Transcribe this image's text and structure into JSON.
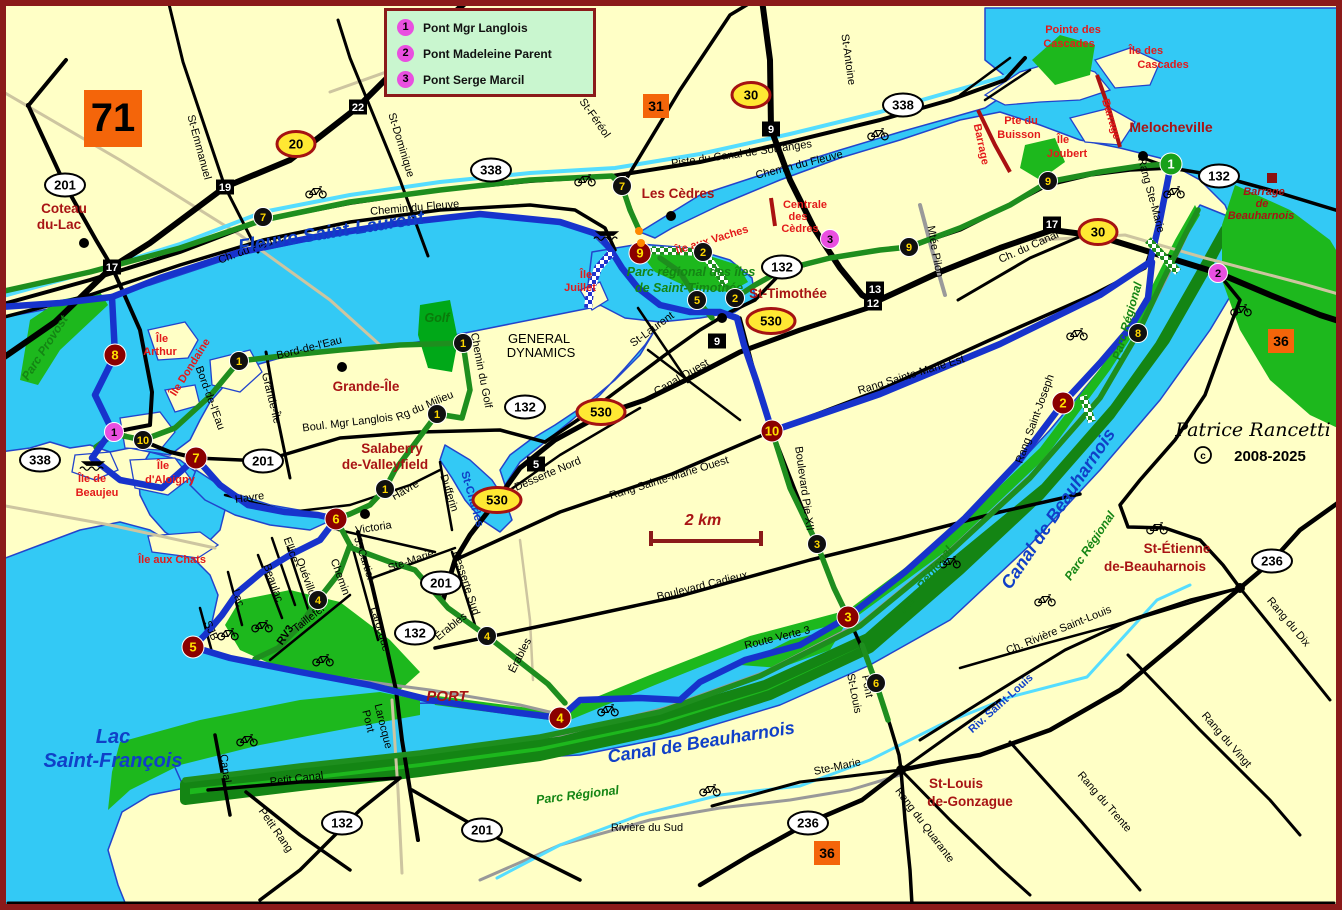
{
  "map_number": "71",
  "legend": {
    "items": [
      {
        "num": "1",
        "label": "Pont Mgr Langlois"
      },
      {
        "num": "2",
        "label": "Pont Madeleine Parent"
      },
      {
        "num": "3",
        "label": "Pont Serge Marcil"
      }
    ]
  },
  "copyright": {
    "signature": "Patrice Rancetti",
    "years": "2008-2025"
  },
  "scale": {
    "label": "2 km"
  },
  "palette": {
    "road": "#000000",
    "town": "#A81414",
    "island": "#E31A1A",
    "water": "#1040C8",
    "park": "#148514",
    "golf": "#0A7A0A",
    "sig": "#000000",
    "water_fill": "#33C9F5",
    "land": "#FFFFC6",
    "green_fill": "#1DB81D",
    "blue_route": "#1733CC",
    "green_route": "#1E8E1E",
    "maroon": "#8B0000",
    "magenta": "#E94FE0",
    "orange_ref": "#F4650A",
    "shield_yellow": "#FFE833"
  },
  "labels": [
    {
      "t": "St-Emmanuel",
      "x": 196,
      "y": 148,
      "r": 75
    },
    {
      "t": "St-Dominique",
      "x": 398,
      "y": 146,
      "r": 73
    },
    {
      "t": "St-Féréol",
      "x": 592,
      "y": 120,
      "r": 55
    },
    {
      "t": "St-Antoine",
      "x": 845,
      "y": 60,
      "r": 82
    },
    {
      "t": "Piste du Canal de Soulanges",
      "x": 742,
      "y": 157,
      "r": -8
    },
    {
      "t": "Chemin du Fleuve",
      "x": 800,
      "y": 168,
      "r": -14
    },
    {
      "t": "Chemin du Fleuve",
      "x": 415,
      "y": 211,
      "r": -5
    },
    {
      "t": "Ch. du Fleuve",
      "x": 252,
      "y": 252,
      "r": -20
    },
    {
      "t": "Ch. du Canal",
      "x": 1030,
      "y": 250,
      "r": -24
    },
    {
      "t": "Mtée Pilon",
      "x": 932,
      "y": 252,
      "r": 80
    },
    {
      "t": "Rang Ste-Marie",
      "x": 1148,
      "y": 196,
      "r": 75
    },
    {
      "t": "Canal Ouest",
      "x": 683,
      "y": 380,
      "r": -30
    },
    {
      "t": "St-Laurent",
      "x": 654,
      "y": 332,
      "r": -36
    },
    {
      "t": "Rang Sainte-Marie Est",
      "x": 912,
      "y": 378,
      "r": -17
    },
    {
      "t": "Rang Sainte-Marie Ouest",
      "x": 670,
      "y": 481,
      "r": -17
    },
    {
      "t": "Boulevard Pie XII",
      "x": 801,
      "y": 489,
      "r": 82
    },
    {
      "t": "Boulevard Cadieux",
      "x": 703,
      "y": 589,
      "r": -14
    },
    {
      "t": "Route Verte 3",
      "x": 778,
      "y": 641,
      "r": -14
    },
    {
      "t": "Desserte Nord",
      "x": 549,
      "y": 477,
      "r": -23
    },
    {
      "t": "Desserte Sud",
      "x": 463,
      "y": 584,
      "r": 72
    },
    {
      "t": "Rang Saint-Joseph",
      "x": 1038,
      "y": 420,
      "r": -70
    },
    {
      "t": "Rang du Dix",
      "x": 1286,
      "y": 624,
      "r": 50
    },
    {
      "t": "Rang du Vingt",
      "x": 1224,
      "y": 742,
      "r": 49
    },
    {
      "t": "Rang du Trente",
      "x": 1102,
      "y": 804,
      "r": 49
    },
    {
      "t": "Ch. Rivière Saint-Louis",
      "x": 1060,
      "y": 633,
      "r": -22
    },
    {
      "t": "Rang du Quarante",
      "x": 922,
      "y": 827,
      "r": 53
    },
    {
      "t": "Ste-Marie",
      "x": 838,
      "y": 770,
      "r": -12
    },
    {
      "t": "Ste-Marie",
      "x": 412,
      "y": 564,
      "r": -19
    },
    {
      "t": "Victoria",
      "x": 374,
      "y": 531,
      "r": -9
    },
    {
      "t": "J.-Cartier",
      "x": 361,
      "y": 560,
      "r": 72
    },
    {
      "t": "Chemin",
      "x": 337,
      "y": 578,
      "r": 70
    },
    {
      "t": "Larocque",
      "x": 377,
      "y": 630,
      "r": 74
    },
    {
      "t": "Ellice",
      "x": 288,
      "y": 551,
      "r": 70
    },
    {
      "t": "Quévillon",
      "x": 304,
      "y": 581,
      "r": 70
    },
    {
      "t": "Beaulac",
      "x": 270,
      "y": 584,
      "r": 70
    },
    {
      "t": "Lac",
      "x": 235,
      "y": 599,
      "r": 70
    },
    {
      "t": "SJB",
      "x": 208,
      "y": 632,
      "r": 66
    },
    {
      "t": "Taillefer",
      "x": 311,
      "y": 621,
      "r": -38
    },
    {
      "t": "RV3",
      "x": 288,
      "y": 637,
      "r": -56,
      "b": 1
    },
    {
      "t": "Havre",
      "x": 250,
      "y": 501,
      "r": -8
    },
    {
      "t": "Havre",
      "x": 407,
      "y": 493,
      "r": -30
    },
    {
      "t": "Dufferin",
      "x": 446,
      "y": 494,
      "r": 72
    },
    {
      "t": "Grande-Île",
      "x": 268,
      "y": 399,
      "r": 76
    },
    {
      "t": "Bord-de-l'Eau",
      "x": 310,
      "y": 351,
      "r": -14
    },
    {
      "t": "Bord-de-l'Eau",
      "x": 207,
      "y": 399,
      "r": 70
    },
    {
      "t": "Rg du Milieu",
      "x": 426,
      "y": 409,
      "r": -23
    },
    {
      "t": "Boul. Mgr Langlois",
      "x": 348,
      "y": 426,
      "r": -7
    },
    {
      "t": "Chemin du Golf",
      "x": 478,
      "y": 371,
      "r": 79
    },
    {
      "t": "Petit Canal",
      "x": 297,
      "y": 782,
      "r": -7
    },
    {
      "t": "Petit Rang",
      "x": 273,
      "y": 832,
      "r": 55
    },
    {
      "t": "Canal",
      "x": 222,
      "y": 769,
      "r": 82
    },
    {
      "t": "Pont",
      "x": 365,
      "y": 722,
      "r": 76
    },
    {
      "t": "Larocque",
      "x": 380,
      "y": 727,
      "r": 76
    },
    {
      "t": "Pont",
      "x": 864,
      "y": 687,
      "r": 79
    },
    {
      "t": "St-Louis",
      "x": 851,
      "y": 694,
      "r": 79
    },
    {
      "t": "Érables",
      "x": 453,
      "y": 629,
      "r": -39
    },
    {
      "t": "Érables",
      "x": 523,
      "y": 657,
      "r": -63
    },
    {
      "t": "Rivière du Sud",
      "x": 647,
      "y": 831
    },
    {
      "t": "GENERAL",
      "x": 539,
      "y": 343,
      "s": 13
    },
    {
      "t": "DYNAMICS",
      "x": 541,
      "y": 357,
      "s": 13
    },
    {
      "t": "Coteau",
      "x": 64,
      "y": 213,
      "c": "town",
      "b": 1,
      "s": 13.5
    },
    {
      "t": "du-Lac",
      "x": 59,
      "y": 229,
      "c": "town",
      "b": 1,
      "s": 13.5
    },
    {
      "t": "Les Cèdres",
      "x": 678,
      "y": 198,
      "c": "town",
      "b": 1,
      "s": 13.5
    },
    {
      "t": "Melocheville",
      "x": 1171,
      "y": 132,
      "c": "town",
      "b": 1,
      "s": 14
    },
    {
      "t": "St-Timothée",
      "x": 788,
      "y": 298,
      "c": "town",
      "b": 1,
      "s": 13.5
    },
    {
      "t": "Grande-Île",
      "x": 366,
      "y": 391,
      "c": "town",
      "b": 1,
      "s": 13.5
    },
    {
      "t": "Salaberry",
      "x": 392,
      "y": 453,
      "c": "town",
      "b": 1,
      "s": 13.5
    },
    {
      "t": "de-Valleyfield",
      "x": 385,
      "y": 469,
      "c": "town",
      "b": 1,
      "s": 13.5
    },
    {
      "t": "St-Louis",
      "x": 956,
      "y": 788,
      "c": "town",
      "b": 1,
      "s": 13.5
    },
    {
      "t": "de-Gonzague",
      "x": 970,
      "y": 806,
      "c": "town",
      "b": 1,
      "s": 13.5
    },
    {
      "t": "St-Étienne",
      "x": 1177,
      "y": 553,
      "c": "town",
      "b": 1,
      "s": 13.5
    },
    {
      "t": "de-Beauharnois",
      "x": 1155,
      "y": 571,
      "c": "town",
      "b": 1,
      "s": 13.5
    },
    {
      "t": "PORT",
      "x": 447,
      "y": 701,
      "c": "town",
      "b": 1,
      "i": 1,
      "s": 15
    },
    {
      "t": "2 km",
      "x": 703,
      "y": 525,
      "c": "town",
      "b": 1,
      "i": 1,
      "s": 16
    },
    {
      "t": "Île",
      "x": 162,
      "y": 342,
      "c": "island",
      "b": 1
    },
    {
      "t": "Arthur",
      "x": 160,
      "y": 355,
      "c": "island",
      "b": 1
    },
    {
      "t": "Île Dondaine",
      "x": 193,
      "y": 369,
      "r": -58,
      "c": "island",
      "b": 1
    },
    {
      "t": "Île de",
      "x": 92,
      "y": 482,
      "c": "island",
      "b": 1
    },
    {
      "t": "Beaujeu",
      "x": 97,
      "y": 496,
      "c": "island",
      "b": 1
    },
    {
      "t": "Île",
      "x": 163,
      "y": 469,
      "c": "island",
      "b": 1
    },
    {
      "t": "d'Aloigny",
      "x": 170,
      "y": 483,
      "c": "island",
      "b": 1
    },
    {
      "t": "Île aux Chats",
      "x": 172,
      "y": 563,
      "c": "island",
      "b": 1
    },
    {
      "t": "Île",
      "x": 586,
      "y": 278,
      "c": "island",
      "b": 1
    },
    {
      "t": "Juillet",
      "x": 580,
      "y": 291,
      "c": "island",
      "b": 1
    },
    {
      "t": "Île aux Vaches",
      "x": 713,
      "y": 243,
      "r": -17,
      "c": "island",
      "b": 1
    },
    {
      "t": "Pointe des",
      "x": 1073,
      "y": 33,
      "c": "island",
      "b": 1
    },
    {
      "t": "Cascades",
      "x": 1069,
      "y": 47,
      "c": "island",
      "b": 1
    },
    {
      "t": "Île des",
      "x": 1146,
      "y": 54,
      "c": "island",
      "b": 1
    },
    {
      "t": "Cascades",
      "x": 1163,
      "y": 68,
      "c": "island",
      "b": 1
    },
    {
      "t": "Pte du",
      "x": 1021,
      "y": 124,
      "c": "island",
      "b": 1
    },
    {
      "t": "Buisson",
      "x": 1019,
      "y": 138,
      "c": "island",
      "b": 1
    },
    {
      "t": "Île",
      "x": 1063,
      "y": 143,
      "c": "island",
      "b": 1
    },
    {
      "t": "Joubert",
      "x": 1067,
      "y": 157,
      "c": "island",
      "b": 1
    },
    {
      "t": "Barrage",
      "x": 978,
      "y": 145,
      "r": 78,
      "c": "island",
      "b": 1
    },
    {
      "t": "Barrage",
      "x": 1108,
      "y": 120,
      "r": 73,
      "c": "island",
      "b": 1
    },
    {
      "t": "Centrale",
      "x": 805,
      "y": 208,
      "c": "island",
      "b": 1
    },
    {
      "t": "des",
      "x": 798,
      "y": 220,
      "c": "island",
      "b": 1
    },
    {
      "t": "Cèdres",
      "x": 800,
      "y": 232,
      "c": "island",
      "b": 1
    },
    {
      "t": "Barrage",
      "x": 1264,
      "y": 195,
      "c": "town",
      "b": 1,
      "i": 1
    },
    {
      "t": "de",
      "x": 1262,
      "y": 207,
      "c": "town",
      "b": 1,
      "i": 1
    },
    {
      "t": "Beauharnois",
      "x": 1261,
      "y": 219,
      "c": "town",
      "b": 1,
      "i": 1
    },
    {
      "t": "Fleuve Saint-Laurent",
      "x": 332,
      "y": 238,
      "s": 19,
      "r": -9,
      "c": "water",
      "b": 1,
      "i": 1
    },
    {
      "t": "Lac",
      "x": 113,
      "y": 743,
      "s": 20,
      "c": "water",
      "b": 1,
      "i": 1
    },
    {
      "t": "Saint-François",
      "x": 113,
      "y": 767,
      "s": 20,
      "c": "water",
      "b": 1,
      "i": 1
    },
    {
      "t": "Canal de Beauharnois",
      "x": 702,
      "y": 748,
      "s": 18,
      "r": -9,
      "c": "water",
      "b": 1,
      "i": 1
    },
    {
      "t": "Canal de Beauharnois",
      "x": 1063,
      "y": 512,
      "s": 18,
      "r": -56,
      "c": "water",
      "b": 1,
      "i": 1
    },
    {
      "t": "St-Charles",
      "x": 469,
      "y": 500,
      "s": 11.5,
      "r": 74,
      "c": "water",
      "b": 1
    },
    {
      "t": "Riv. Saint-Louis",
      "x": 1003,
      "y": 706,
      "s": 11,
      "r": -42,
      "c": "water",
      "b": 1
    },
    {
      "t": "Parc régional des îles",
      "x": 691,
      "y": 276,
      "s": 12.5,
      "c": "park",
      "b": 1,
      "i": 1
    },
    {
      "t": "de Saint-Timothée",
      "x": 689,
      "y": 292,
      "s": 12.5,
      "c": "park",
      "b": 1,
      "i": 1
    },
    {
      "t": "Parc Régional",
      "x": 578,
      "y": 799,
      "r": -7,
      "s": 12.5,
      "c": "park",
      "b": 1,
      "i": 1
    },
    {
      "t": "Parc Régional",
      "x": 929,
      "y": 582,
      "r": -53,
      "s": 12,
      "c": "park",
      "b": 1,
      "i": 1
    },
    {
      "t": "Parc Régional",
      "x": 1093,
      "y": 548,
      "r": -56,
      "s": 12,
      "c": "park",
      "b": 1,
      "i": 1
    },
    {
      "t": "Parc Régional",
      "x": 1131,
      "y": 322,
      "r": -74,
      "s": 12,
      "c": "park",
      "b": 1,
      "i": 1
    },
    {
      "t": "Parc Provost",
      "x": 48,
      "y": 350,
      "r": -57,
      "s": 12,
      "c": "park",
      "b": 1,
      "i": 1
    },
    {
      "t": "Golf",
      "x": 437,
      "y": 322,
      "s": 12.5,
      "c": "golf",
      "b": 1,
      "i": 1
    }
  ],
  "markers": {
    "circles": [
      {
        "n": "1",
        "x": 1171,
        "y": 164,
        "k": "g"
      },
      {
        "n": "2",
        "x": 1063,
        "y": 403,
        "k": "m"
      },
      {
        "n": "3",
        "x": 848,
        "y": 617,
        "k": "m"
      },
      {
        "n": "4",
        "x": 560,
        "y": 718,
        "k": "m"
      },
      {
        "n": "5",
        "x": 193,
        "y": 647,
        "k": "m"
      },
      {
        "n": "6",
        "x": 336,
        "y": 519,
        "k": "m"
      },
      {
        "n": "7",
        "x": 196,
        "y": 458,
        "k": "m"
      },
      {
        "n": "8",
        "x": 115,
        "y": 355,
        "k": "m"
      },
      {
        "n": "9",
        "x": 640,
        "y": 253,
        "k": "m"
      },
      {
        "n": "10",
        "x": 772,
        "y": 431,
        "k": "m"
      },
      {
        "n": "1",
        "x": 239,
        "y": 361,
        "k": "b"
      },
      {
        "n": "1",
        "x": 463,
        "y": 343,
        "k": "b"
      },
      {
        "n": "1",
        "x": 437,
        "y": 414,
        "k": "b"
      },
      {
        "n": "1",
        "x": 385,
        "y": 489,
        "k": "b"
      },
      {
        "n": "2",
        "x": 703,
        "y": 252,
        "k": "b"
      },
      {
        "n": "2",
        "x": 735,
        "y": 298,
        "k": "b"
      },
      {
        "n": "3",
        "x": 817,
        "y": 544,
        "k": "b"
      },
      {
        "n": "4",
        "x": 318,
        "y": 600,
        "k": "b"
      },
      {
        "n": "4",
        "x": 487,
        "y": 636,
        "k": "b"
      },
      {
        "n": "5",
        "x": 697,
        "y": 300,
        "k": "b"
      },
      {
        "n": "6",
        "x": 876,
        "y": 683,
        "k": "b"
      },
      {
        "n": "7",
        "x": 263,
        "y": 217,
        "k": "b"
      },
      {
        "n": "7",
        "x": 622,
        "y": 186,
        "k": "b"
      },
      {
        "n": "8",
        "x": 1138,
        "y": 333,
        "k": "b"
      },
      {
        "n": "9",
        "x": 909,
        "y": 247,
        "k": "b"
      },
      {
        "n": "9",
        "x": 1048,
        "y": 181,
        "k": "b"
      },
      {
        "n": "10",
        "x": 143,
        "y": 440,
        "k": "b"
      },
      {
        "n": "1",
        "x": 114,
        "y": 432,
        "k": "p"
      },
      {
        "n": "2",
        "x": 1218,
        "y": 273,
        "k": "p"
      },
      {
        "n": "3",
        "x": 830,
        "y": 239,
        "k": "p"
      }
    ],
    "exit_squares": [
      {
        "n": "22",
        "x": 358,
        "y": 107
      },
      {
        "n": "19",
        "x": 225,
        "y": 187
      },
      {
        "n": "17",
        "x": 112,
        "y": 267
      },
      {
        "n": "9",
        "x": 771,
        "y": 129
      },
      {
        "n": "13",
        "x": 875,
        "y": 289
      },
      {
        "n": "12",
        "x": 873,
        "y": 303
      },
      {
        "n": "17",
        "x": 1052,
        "y": 224
      },
      {
        "n": "9",
        "x": 717,
        "y": 341
      },
      {
        "n": "5",
        "x": 536,
        "y": 464
      }
    ],
    "autoroute_shields": [
      {
        "n": "20",
        "x": 296,
        "y": 144
      },
      {
        "n": "30",
        "x": 751,
        "y": 95
      },
      {
        "n": "30",
        "x": 1098,
        "y": 232
      },
      {
        "n": "530",
        "x": 771,
        "y": 321
      },
      {
        "n": "530",
        "x": 601,
        "y": 412
      },
      {
        "n": "530",
        "x": 497,
        "y": 500
      }
    ],
    "route_shields": [
      {
        "n": "201",
        "x": 65,
        "y": 185
      },
      {
        "n": "338",
        "x": 491,
        "y": 170
      },
      {
        "n": "338",
        "x": 903,
        "y": 105
      },
      {
        "n": "338",
        "x": 40,
        "y": 460
      },
      {
        "n": "201",
        "x": 263,
        "y": 461
      },
      {
        "n": "132",
        "x": 782,
        "y": 267
      },
      {
        "n": "132",
        "x": 525,
        "y": 407
      },
      {
        "n": "132",
        "x": 1219,
        "y": 176
      },
      {
        "n": "201",
        "x": 441,
        "y": 583
      },
      {
        "n": "132",
        "x": 415,
        "y": 633
      },
      {
        "n": "132",
        "x": 342,
        "y": 823
      },
      {
        "n": "201",
        "x": 482,
        "y": 830
      },
      {
        "n": "236",
        "x": 1272,
        "y": 561
      },
      {
        "n": "236",
        "x": 808,
        "y": 823
      }
    ],
    "adjacent_maps": [
      {
        "n": "31",
        "x": 656,
        "y": 106
      },
      {
        "n": "36",
        "x": 1281,
        "y": 341
      },
      {
        "n": "36",
        "x": 827,
        "y": 853
      }
    ],
    "town_dots": [
      {
        "x": 84,
        "y": 243
      },
      {
        "x": 671,
        "y": 216
      },
      {
        "x": 1143,
        "y": 156
      },
      {
        "x": 722,
        "y": 318
      },
      {
        "x": 342,
        "y": 367
      },
      {
        "x": 365,
        "y": 514
      },
      {
        "x": 901,
        "y": 770
      },
      {
        "x": 1240,
        "y": 588
      }
    ],
    "beach_dots": [
      {
        "x": 639,
        "y": 231
      },
      {
        "x": 641,
        "y": 243
      }
    ],
    "dam_square": {
      "x": 1272,
      "y": 178
    }
  },
  "icons": {
    "bicycles": [
      {
        "x": 316,
        "y": 192
      },
      {
        "x": 585,
        "y": 180
      },
      {
        "x": 878,
        "y": 134
      },
      {
        "x": 1174,
        "y": 192
      },
      {
        "x": 1077,
        "y": 334
      },
      {
        "x": 1241,
        "y": 310
      },
      {
        "x": 228,
        "y": 634
      },
      {
        "x": 262,
        "y": 626
      },
      {
        "x": 323,
        "y": 660
      },
      {
        "x": 247,
        "y": 740
      },
      {
        "x": 608,
        "y": 710
      },
      {
        "x": 950,
        "y": 562
      },
      {
        "x": 1157,
        "y": 528
      },
      {
        "x": 1045,
        "y": 600
      },
      {
        "x": 710,
        "y": 790
      }
    ],
    "boats": [
      {
        "x": 607,
        "y": 234
      },
      {
        "x": 93,
        "y": 464
      }
    ]
  }
}
